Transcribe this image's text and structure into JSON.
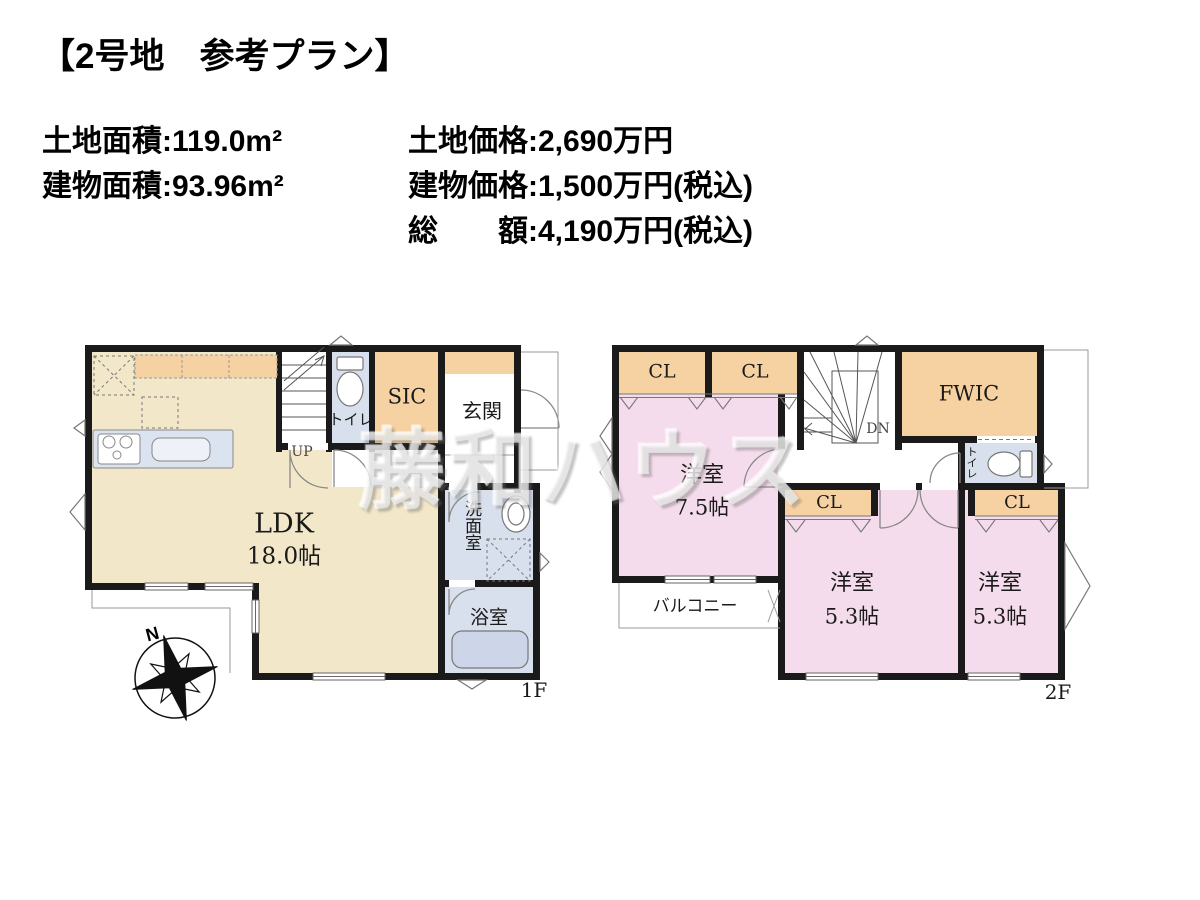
{
  "title": "【2号地　参考プラン】",
  "info": {
    "land_area": "土地面積:119.0m²",
    "building_area": "建物面積:93.96m²",
    "land_price": "土地価格:2,690万円",
    "building_price": "建物価格:1,500万円(税込)",
    "total_price": "総　　額:4,190万円(税込)"
  },
  "watermark": "藤和ハウス",
  "compass_north": "N",
  "floor1": {
    "label": "1F",
    "rooms": {
      "ldk": "LDK",
      "ldk_size": "18.0帖",
      "stairs": "UP",
      "toilet": "トイレ",
      "sic": "SIC",
      "entrance": "玄関",
      "washroom": "洗面室",
      "bathroom": "浴室"
    }
  },
  "floor2": {
    "label": "2F",
    "rooms": {
      "closet": "CL",
      "fwic": "FWIC",
      "stairs": "DN",
      "toilet": "トイレ",
      "bedroom1": "洋室",
      "bedroom1_size": "7.5帖",
      "bedroom2": "洋室",
      "bedroom2_size": "5.3帖",
      "bedroom3": "洋室",
      "bedroom3_size": "5.3帖",
      "balcony": "バルコニー"
    }
  },
  "colors": {
    "ldk_fill": "#f2e7c9",
    "closet_fill": "#f6d1a2",
    "bedroom_fill": "#f5dcec",
    "wet_area_fill": "#d9e0ed",
    "wall": "#1a1a1a"
  }
}
